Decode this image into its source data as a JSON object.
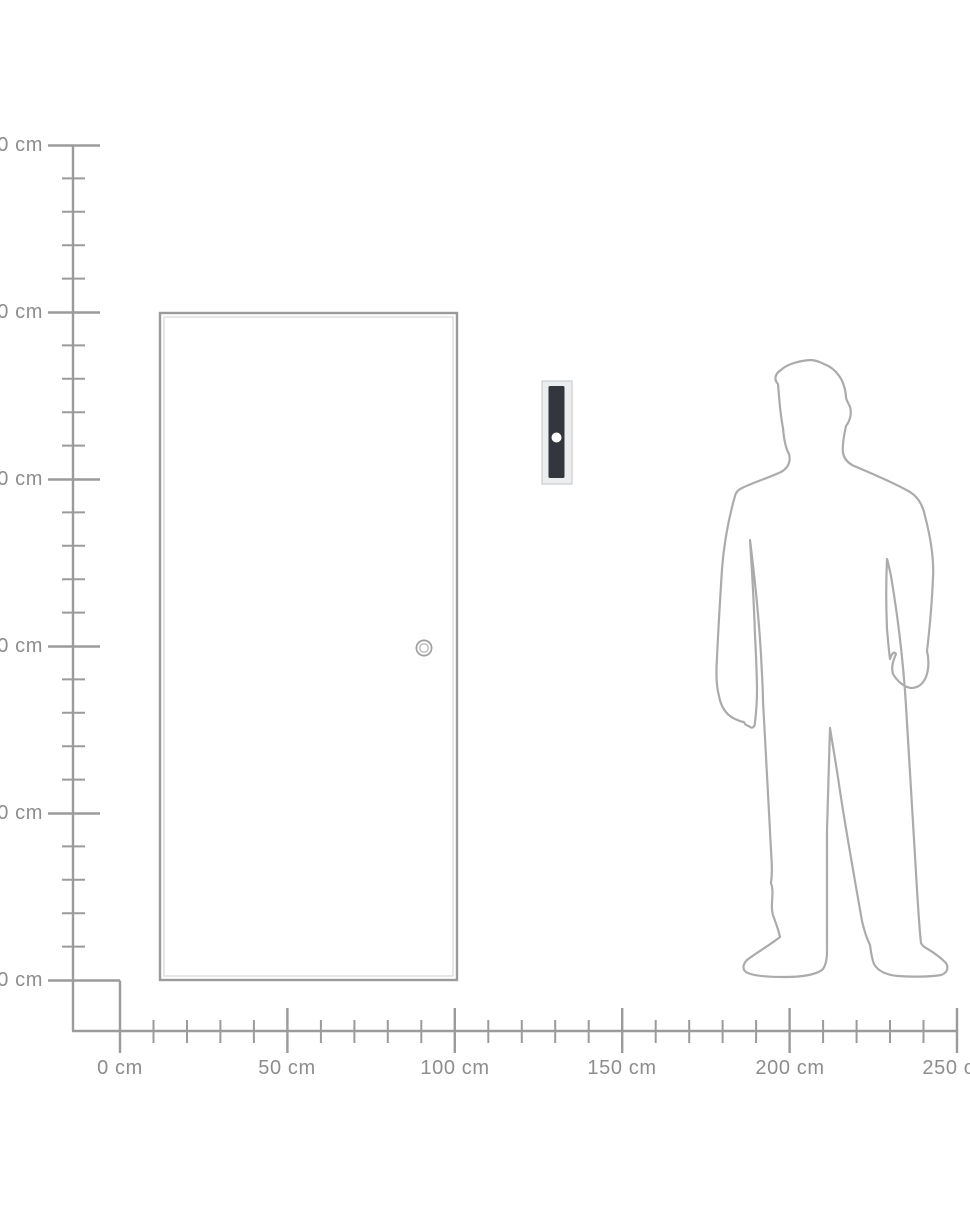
{
  "diagram": {
    "type": "product-size-guide",
    "unit": "cm",
    "figures": {
      "door": "door outline with round knob",
      "product": "wall-mounted vertical dark bar with round white button on light back plate",
      "person": "standing man outline silhouette for scale"
    }
  },
  "vertical_ruler": {
    "unit": "cm",
    "labels": [
      "250 cm",
      "200 cm",
      "150 cm",
      "100 cm",
      "50 cm",
      "0 cm"
    ]
  },
  "horizontal_ruler": {
    "unit": "cm",
    "labels": [
      "0 cm",
      "50 cm",
      "100 cm",
      "150 cm",
      "200 cm",
      "250 cm"
    ]
  },
  "colors": {
    "background": "#ffffff",
    "ruler_line": "#9b9b9b",
    "label_text": "#8d8d8d",
    "door_outline": "#9b9b9b",
    "door_inner_line": "#d9d9d9",
    "silhouette_outline": "#ababab",
    "product_plate": "#ebedef",
    "product_plate_border": "#cbcdcf",
    "product_bar": "#33373d",
    "product_button": "#ffffff"
  }
}
